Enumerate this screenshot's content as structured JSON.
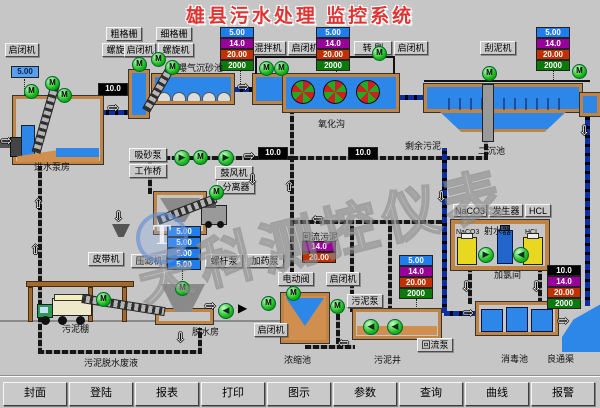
{
  "title": "雄县污水处理 监控系统",
  "watermark": {
    "text": "天科测控仪表",
    "logo": "T"
  },
  "motor": "M",
  "toolbar": {
    "items": [
      "封面",
      "登陆",
      "报表",
      "打印",
      "图示",
      "参数",
      "查询",
      "曲线",
      "报警"
    ]
  },
  "buttons": {
    "coarse_screen": "粗格栅",
    "fine_screen": "细格栅",
    "hoist": "启闭机",
    "screw": "螺旋机",
    "mixer": "混拌机",
    "brush": "转 刷",
    "scraper": "刮泥机",
    "sand_pump": "吸砂泵",
    "work_bridge": "工作桥",
    "blower": "鼓风机",
    "separator": "分离器",
    "belt": "皮带机",
    "filter_press": "压滤机",
    "screw_pump": "螺杆泵",
    "dosing_pump": "加药泵",
    "electric_valve": "电动阀",
    "sludge_pump": "污泥泵",
    "reflux_pump": "回流泵",
    "naco3": "NaCO3",
    "generator": "发生器",
    "hcl": "HCL"
  },
  "labels": {
    "inlet_pump_house": "进水泵房",
    "aerated_grit_tank": "曝气沉砂池",
    "oxidation_ditch": "氧化沟",
    "secondary_clarifier": "二沉池",
    "excess_sludge": "剩余污泥",
    "return_sludge": "回流污泥",
    "sludge_shed": "污泥棚",
    "dewatering_house": "脱水房",
    "dewatering_waste": "污泥脱水废液",
    "thickener": "浓缩池",
    "sludge_well": "污泥井",
    "disinfection_tank": "消毒池",
    "outfall_channel": "良通渠",
    "water_jet": "射水器",
    "chlorination_room": "加氯间",
    "naco3_tank": "NaCO3",
    "hcl_tank": "HCL"
  },
  "values": {
    "v_flow_small": "5.00",
    "v_level": "14.0",
    "v_pressure": "20.00",
    "v_total": "2000",
    "v_flow_big": "10.0"
  }
}
